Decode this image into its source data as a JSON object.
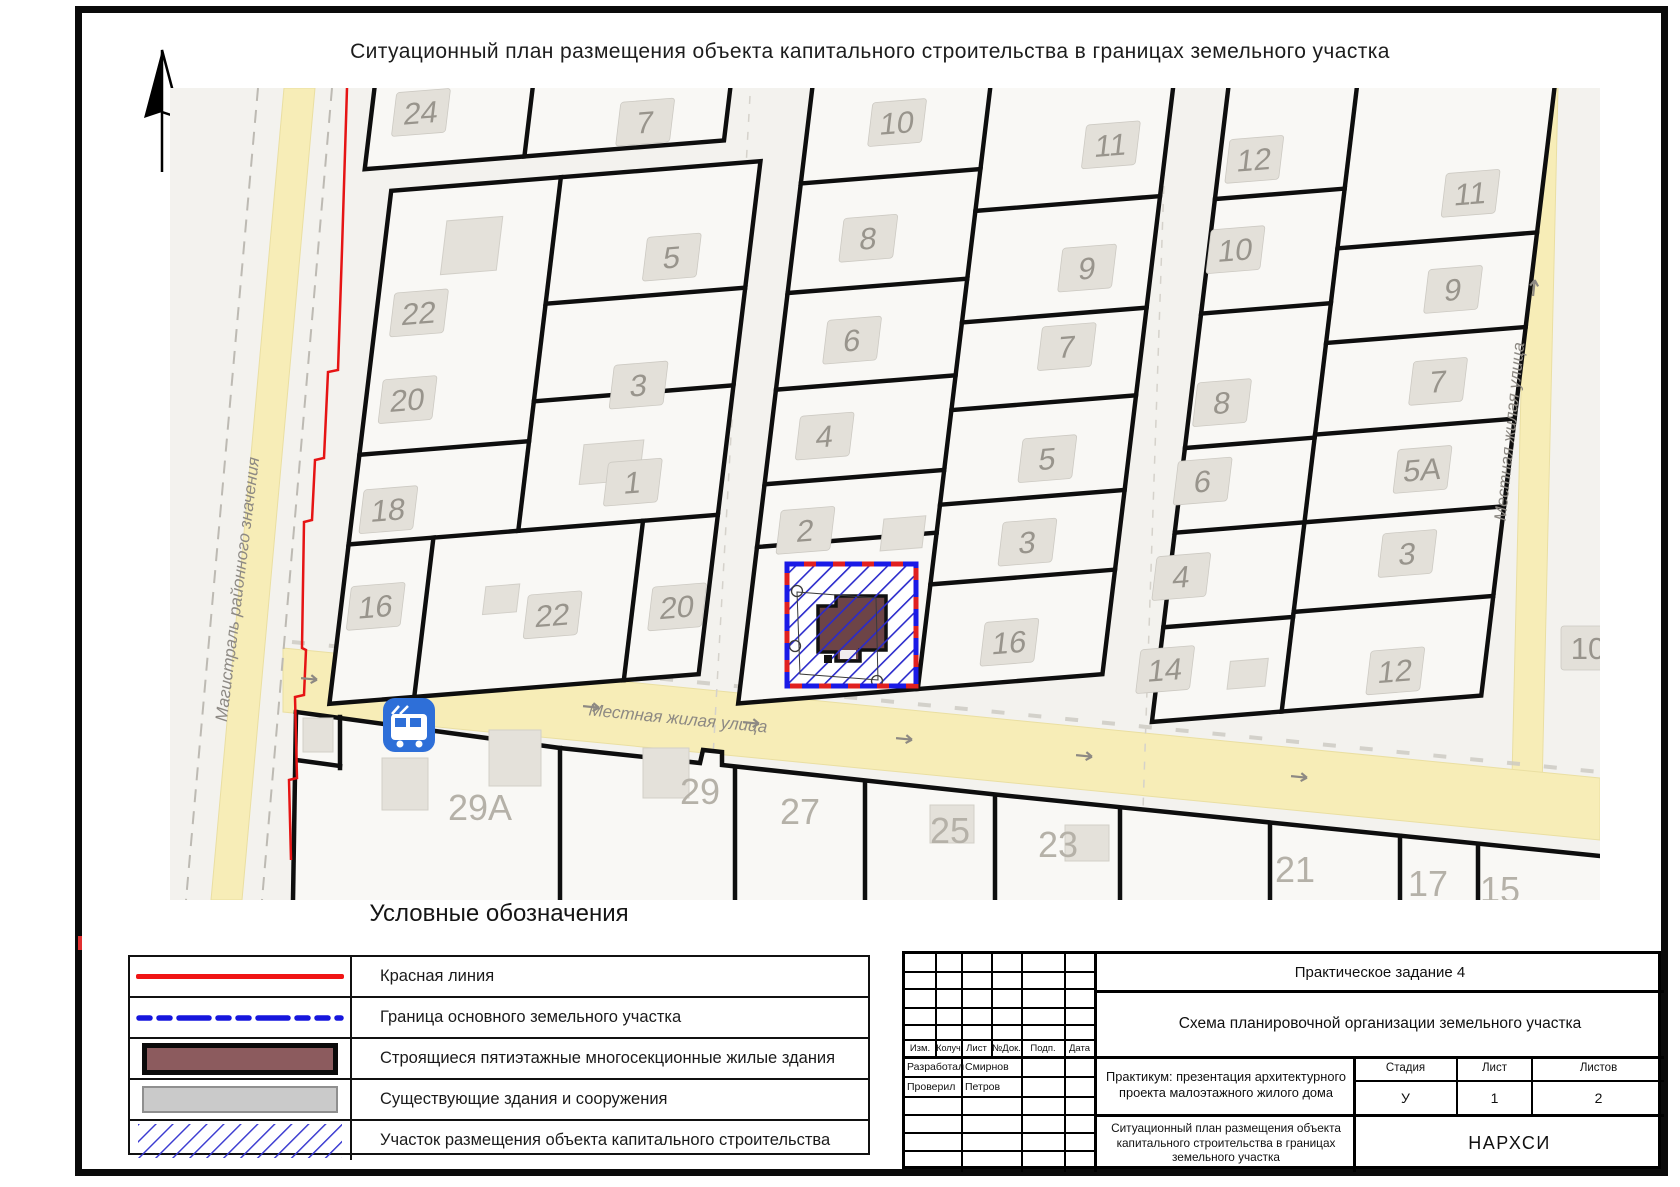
{
  "page": {
    "title": "Ситуационный план размещения объекта капитального строительства в границах земельного участка"
  },
  "north": {
    "label": "С"
  },
  "map": {
    "streets": {
      "left": "Магистраль районного значения",
      "horizontal": "Местная жилая улица",
      "right": "Местная жилая улица"
    },
    "colors": {
      "street_fill": "#f7edb7",
      "red_line": "#e61414",
      "parcel_border": "#1a1ae6",
      "building_new": "#6d4447",
      "building_existing": "#e4e1da",
      "bus_icon": "#2e6fd8"
    },
    "icons": {
      "bus_stop": "bus-stop-icon",
      "north_arrow": "north-arrow-icon"
    },
    "plots": {
      "p24": "24",
      "p7": "7",
      "p22": "22",
      "p5": "5",
      "p20": "20",
      "p3": "3",
      "p18": "18",
      "p1": "1",
      "p16": "16",
      "p22b": "22",
      "p20b": "20",
      "p10": "10",
      "p11": "11",
      "p8": "8",
      "p9": "9",
      "p6": "6",
      "p7b": "7",
      "p4": "4",
      "p5b": "5",
      "p2": "2",
      "p3b": "3",
      "p16b": "16",
      "p12": "12",
      "p10b": "10",
      "p8b": "8",
      "p6b": "6",
      "p4b": "4",
      "p14": "14",
      "p11b": "11",
      "p9b": "9",
      "p7c": "7",
      "p5a": "5А",
      "p3c": "3",
      "p12b": "12",
      "p10c": "10"
    },
    "bottom_plots": {
      "b29a": "29А",
      "b29": "29",
      "b27": "27",
      "b25": "25",
      "b23": "23",
      "b21": "21",
      "b17": "17",
      "b15": "15"
    }
  },
  "legend": {
    "title": "Условные обозначения",
    "rows": [
      {
        "symbol": "red-line",
        "label": "Красная линия"
      },
      {
        "symbol": "blue-dash-line",
        "label": "Граница основного земельного участка"
      },
      {
        "symbol": "maroon-rect",
        "label": "Строящиеся пятиэтажные многосекционные жилые здания"
      },
      {
        "symbol": "gray-rect",
        "label": "Существующие здания и сооружения"
      },
      {
        "symbol": "blue-hatch",
        "label": "Участок размещения объекта капитального строительства"
      }
    ]
  },
  "titleblock": {
    "project": "Практическое задание 4",
    "doc_title": "Схема планировочной организации земельного участка",
    "course": "Практикум: презентация архитектурного проекта малоэтажного жилого дома",
    "sheet_title": "Ситуационный план размещения объекта капитального строительства в границах земельного участка",
    "org": "НАРХСИ",
    "cols": {
      "izm": "Изм.",
      "kol": "Колуч",
      "list": "Лист",
      "ndok": "№Док.",
      "podp": "Подп.",
      "data": "Дата"
    },
    "developed_label": "Разработал",
    "developed_name": "Смирнов",
    "checked_label": "Проверил",
    "checked_name": "Петров",
    "stage_label": "Стадия",
    "stage": "У",
    "sheet_label": "Лист",
    "sheet": "1",
    "sheets_label": "Листов",
    "sheets": "2"
  }
}
